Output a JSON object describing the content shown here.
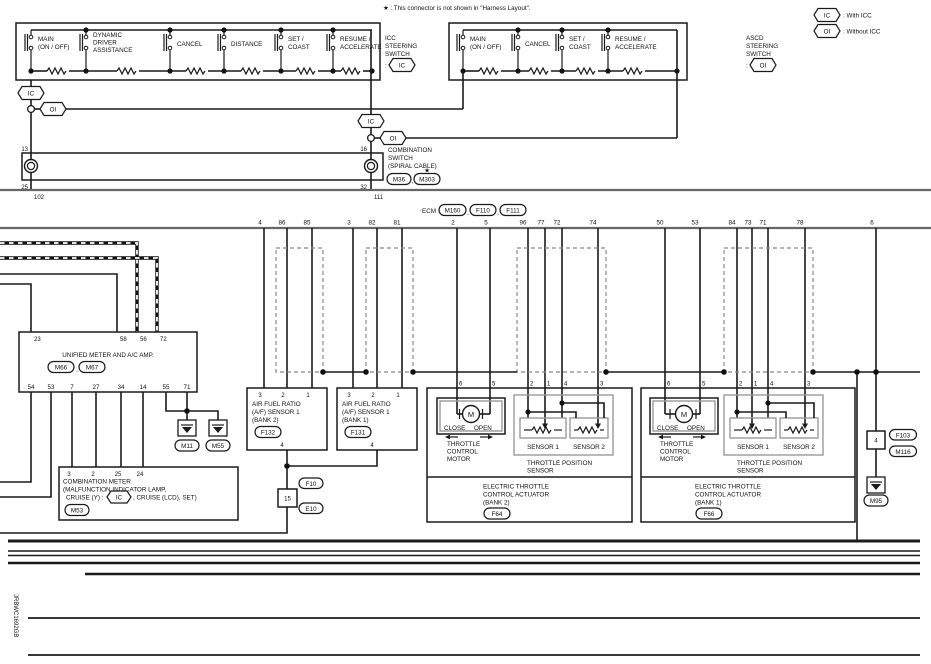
{
  "note": "★ : This connector is not shown in \"Harness Layout\".",
  "legend": {
    "ic_tag": "IC",
    "ic_desc": ": With ICC",
    "oi_tag": "OI",
    "oi_desc": ": Without ICC"
  },
  "icc_switch": {
    "name1": "ICC",
    "name2": "STEERING",
    "name3": "SWITCH",
    "colon": ":",
    "tag": "IC",
    "buttons": {
      "main1": "MAIN",
      "main2": "(ON / OFF)",
      "dyn1": "DYNAMIC",
      "dyn2": "DRIVER",
      "dyn3": "ASSISTANCE",
      "cancel": "CANCEL",
      "distance": "DISTANCE",
      "set1": "SET /",
      "set2": "COAST",
      "res1": "RESUME /",
      "res2": "ACCELERATE"
    }
  },
  "ascd_switch": {
    "name1": "ASCD",
    "name2": "STEERING",
    "name3": "SWITCH",
    "colon": ":",
    "tag": "OI",
    "buttons": {
      "main1": "MAIN",
      "main2": "(ON / OFF)",
      "cancel": "CANCEL",
      "set1": "SET /",
      "set2": "COAST",
      "res1": "RESUME /",
      "res2": "ACCELERATE"
    }
  },
  "branch": {
    "ic1": "IC",
    "oi1": "OI",
    "ic2": "IC",
    "oi2": "OI"
  },
  "spiral": {
    "pin13": "13",
    "pin25": "25",
    "pin16": "16",
    "pin32": "32",
    "name1": "COMBINATION",
    "name2": "SWITCH",
    "name3": "(SPIRAL CABLE)",
    "conn1": "M36",
    "comma": ",",
    "conn2": "M303",
    "star": "★"
  },
  "ecm": {
    "pin102": "102",
    "pin111": "111",
    "label": "ECM",
    "conn1": "M160",
    "c1": ",",
    "conn2": "F110",
    "c2": ",",
    "conn3": "F111",
    "pins": [
      "4",
      "86",
      "85",
      "3",
      "82",
      "81",
      "2",
      "5",
      "96",
      "77",
      "72",
      "74",
      "50",
      "53",
      "84",
      "73",
      "71",
      "78",
      "6"
    ]
  },
  "unified": {
    "name": "UNIFIED METER AND A/C AMP.",
    "conn1": "M66",
    "comma": ",",
    "conn2": "M67",
    "top_pins": [
      "23",
      "58",
      "56",
      "72"
    ],
    "bottom_pins": [
      "54",
      "53",
      "7",
      "27",
      "34",
      "14",
      "55",
      "71"
    ]
  },
  "grounds": {
    "g1": "M11",
    "g2": "M55",
    "g3": "M95"
  },
  "comb_meter": {
    "l1": "COMBINATION METER",
    "l2": "(MALFUNCTION INDICATOR LAMP,",
    "l3a": "CRUISE (Y) :",
    "l3tag": "IC",
    "l3b": ", CRUISE (LCD), SET)",
    "conn": "M53",
    "pins": [
      "3",
      "2",
      "25",
      "24"
    ]
  },
  "af2": {
    "l1": "AIR FUEL RATIO",
    "l2": "(A/F) SENSOR 1",
    "l3": "(BANK 2)",
    "conn": "F132",
    "pins": [
      "3",
      "2",
      "1"
    ],
    "pin4": "4"
  },
  "af1": {
    "l1": "AIR FUEL RATIO",
    "l2": "(A/F) SENSOR 1",
    "l3": "(BANK 1)",
    "conn": "F131",
    "pins": [
      "3",
      "2",
      "1"
    ],
    "pin4": "4"
  },
  "conn15": {
    "num": "15",
    "c1": "F10",
    "c2": "E10"
  },
  "conn4": {
    "num": "4",
    "c1": "F103",
    "c2": "M116"
  },
  "act2": {
    "pins": [
      "6",
      "5",
      "2",
      "1",
      "4",
      "3"
    ],
    "motor": "M",
    "close": "CLOSE",
    "open": "OPEN",
    "m1": "THROTTLE",
    "m2": "CONTROL",
    "m3": "MOTOR",
    "s1": "SENSOR 1",
    "s2": "SENSOR 2",
    "tps1": "THROTTLE POSITION",
    "tps2": "SENSOR",
    "n1": "ELECTRIC THROTTLE",
    "n2": "CONTROL ACTUATOR",
    "n3": "(BANK 2)",
    "conn": "F64"
  },
  "act1": {
    "pins": [
      "6",
      "5",
      "2",
      "1",
      "4",
      "3"
    ],
    "motor": "M",
    "close": "CLOSE",
    "open": "OPEN",
    "m1": "THROTTLE",
    "m2": "CONTROL",
    "m3": "MOTOR",
    "s1": "SENSOR 1",
    "s2": "SENSOR 2",
    "tps1": "THROTTLE POSITION",
    "tps2": "SENSOR",
    "n1": "ELECTRIC THROTTLE",
    "n2": "CONTROL ACTUATOR",
    "n3": "(BANK 1)",
    "conn": "F66"
  },
  "footer_code": "JRBWC1692GB",
  "colors": {
    "wire": "#1a1a1a",
    "gray_component": "#999999",
    "shield_dash": "#888888"
  }
}
